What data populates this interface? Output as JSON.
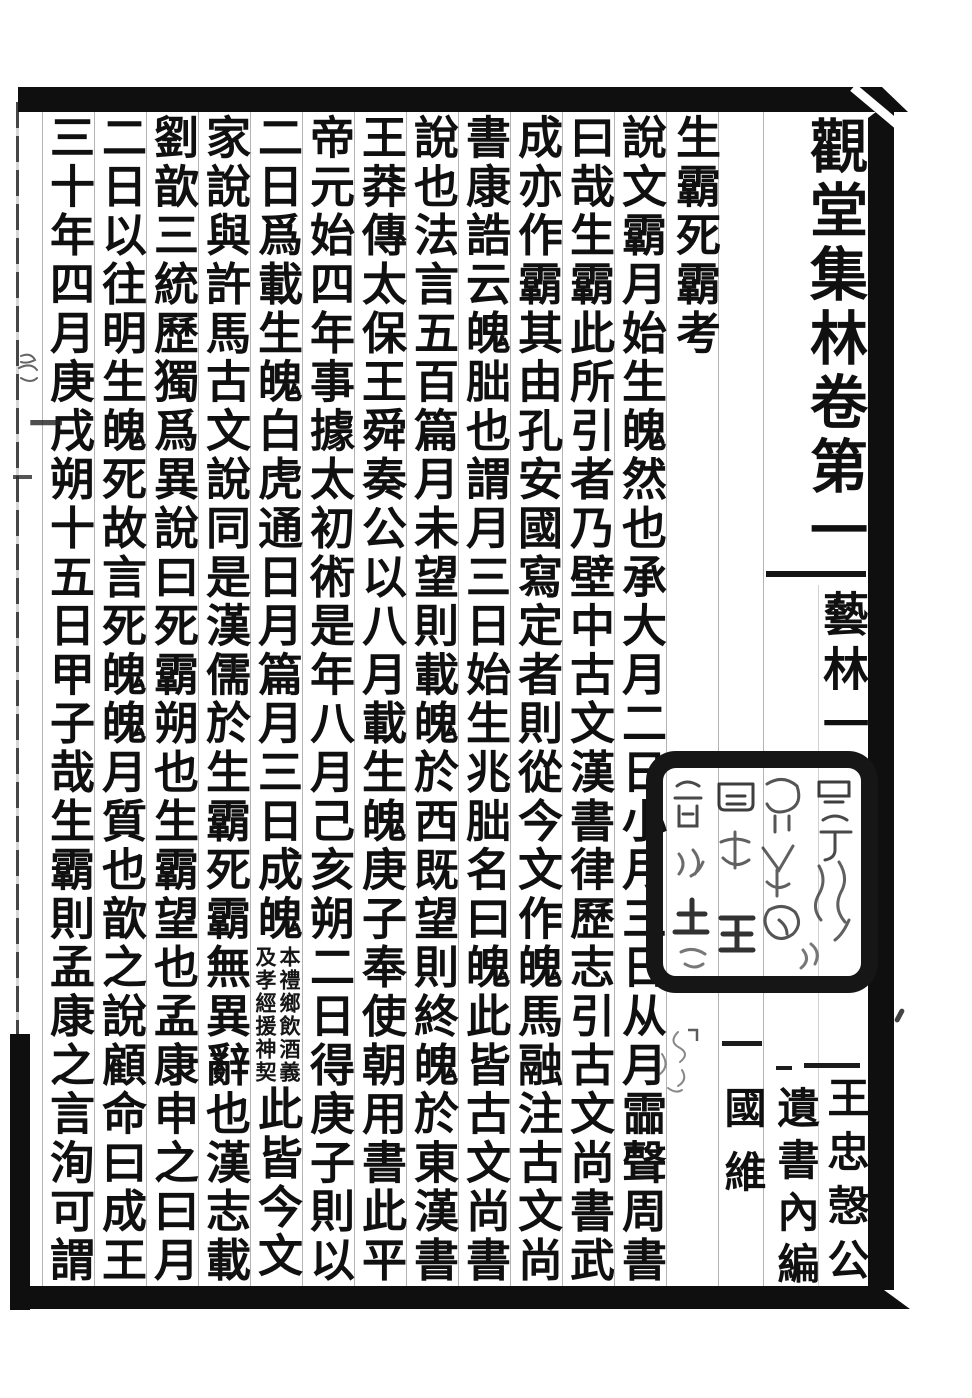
{
  "page": {
    "volume_title": "觀堂集林卷第一",
    "section_label": "藝林一",
    "series_note": {
      "full": "王忠愨公遺書內編",
      "right_half": "王忠愨公",
      "left_half": "遺書內編"
    },
    "author_name": "國維",
    "left_margin_fragment": "記一"
  },
  "essay": {
    "title": "生霸死霸考",
    "columns": [
      "說文霸月始生魄然也承大月二日小月三日从月霝聲周書",
      "曰哉生霸此所引者乃壁中古文漢書律歷志引古文尚書武",
      "成亦作霸其由孔安國寫定者則從今文作魄馬融注古文尚",
      "書康誥云魄朏也謂月三日始生兆朏名曰魄此皆古文尚書",
      "說也法言五百篇月未望則載魄於西既望則終魄於東漢書",
      "王莽傳太保王舜奏公以八月載生魄庚子奉使朝用書此平",
      "帝元始四年事據太初術是年八月己亥朔二日得庚子則以",
      {
        "part1": "二日爲載生魄白虎通日月篇月三日成魄",
        "note_right": "本禮鄉飲酒義",
        "note_left": "及孝經援神契",
        "part2": "此皆今文"
      },
      "家說與許馬古文說同是漢儒於生霸死霸無異辭也漢志載",
      "劉歆三統歷獨爲異說曰死霸朔也生霸望也孟康申之曰月",
      "二日以往明生魄死故言死魄魄月質也歆之說顧命曰成王",
      "三十年四月庚戌朔十五日甲子哉生霸則孟康之言洵可謂"
    ]
  },
  "seal": {
    "type": "collector-seal",
    "script": "seal-script, mostly illegible",
    "legible_glyphs": [
      "王",
      "土"
    ]
  },
  "colors": {
    "ink": "#101010",
    "paper": "#ffffff",
    "rule_line": "#9b9b9b"
  }
}
